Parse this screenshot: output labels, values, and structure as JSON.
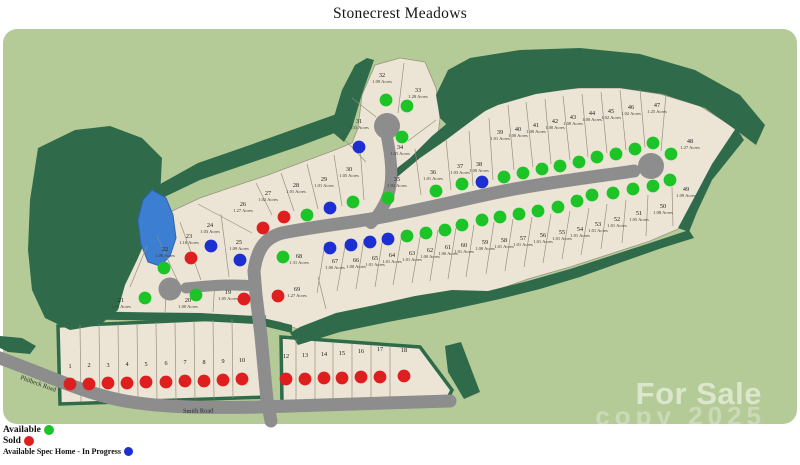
{
  "map": {
    "title": "Stonecrest Meadows",
    "legend": [
      {
        "label": "Available",
        "color": "#1dc427"
      },
      {
        "label": "Sold",
        "color": "#df1f1f"
      },
      {
        "label": "Available Spec Home - In Progress",
        "color": "#1c2fd1"
      }
    ],
    "watermark": {
      "text": "For Sale",
      "partial": "copy 2025"
    },
    "roads": [
      {
        "name": "Philbeck Road"
      },
      {
        "name": "Smith Road"
      }
    ],
    "status_colors": {
      "available": "#1dc427",
      "sold": "#df1f1f",
      "spec": "#1c2fd1"
    },
    "lots": [
      {
        "n": "1",
        "a": "",
        "s": "sold",
        "lx": 70,
        "ly": 368,
        "dx": 70,
        "dy": 384
      },
      {
        "n": "2",
        "a": "",
        "s": "sold",
        "lx": 89,
        "ly": 367,
        "dx": 89,
        "dy": 384
      },
      {
        "n": "3",
        "a": "",
        "s": "sold",
        "lx": 108,
        "ly": 367,
        "dx": 108,
        "dy": 383
      },
      {
        "n": "4",
        "a": "",
        "s": "sold",
        "lx": 127,
        "ly": 366,
        "dx": 127,
        "dy": 383
      },
      {
        "n": "5",
        "a": "",
        "s": "sold",
        "lx": 146,
        "ly": 366,
        "dx": 146,
        "dy": 382
      },
      {
        "n": "6",
        "a": "",
        "s": "sold",
        "lx": 166,
        "ly": 365,
        "dx": 166,
        "dy": 382
      },
      {
        "n": "7",
        "a": "",
        "s": "sold",
        "lx": 185,
        "ly": 364,
        "dx": 185,
        "dy": 381
      },
      {
        "n": "8",
        "a": "",
        "s": "sold",
        "lx": 204,
        "ly": 364,
        "dx": 204,
        "dy": 381
      },
      {
        "n": "9",
        "a": "",
        "s": "sold",
        "lx": 223,
        "ly": 363,
        "dx": 223,
        "dy": 380
      },
      {
        "n": "10",
        "a": "",
        "s": "sold",
        "lx": 242,
        "ly": 362,
        "dx": 242,
        "dy": 379
      },
      {
        "n": "12",
        "a": "",
        "s": "sold",
        "lx": 286,
        "ly": 358,
        "dx": 286,
        "dy": 379
      },
      {
        "n": "13",
        "a": "",
        "s": "sold",
        "lx": 305,
        "ly": 357,
        "dx": 305,
        "dy": 379
      },
      {
        "n": "14",
        "a": "",
        "s": "sold",
        "lx": 324,
        "ly": 356,
        "dx": 324,
        "dy": 378
      },
      {
        "n": "15",
        "a": "",
        "s": "sold",
        "lx": 342,
        "ly": 355,
        "dx": 342,
        "dy": 378
      },
      {
        "n": "16",
        "a": "",
        "s": "sold",
        "lx": 361,
        "ly": 353,
        "dx": 361,
        "dy": 377
      },
      {
        "n": "17",
        "a": "",
        "s": "sold",
        "lx": 380,
        "ly": 351,
        "dx": 380,
        "dy": 377
      },
      {
        "n": "18",
        "a": "",
        "s": "sold",
        "lx": 404,
        "ly": 352,
        "dx": 404,
        "dy": 376
      },
      {
        "n": "19",
        "a": "1.05",
        "s": "sold",
        "lx": 228,
        "ly": 294,
        "dx": 244,
        "dy": 299
      },
      {
        "n": "20",
        "a": "1.00",
        "s": "available",
        "lx": 188,
        "ly": 302,
        "dx": 196,
        "dy": 295
      },
      {
        "n": "21",
        "a": "1.10",
        "s": "available",
        "lx": 121,
        "ly": 302,
        "dx": 145,
        "dy": 298
      },
      {
        "n": "22",
        "a": "1.06",
        "s": "available",
        "lx": 165,
        "ly": 251,
        "dx": 164,
        "dy": 268
      },
      {
        "n": "23",
        "a": "1.10",
        "s": "sold",
        "lx": 189,
        "ly": 238,
        "dx": 191,
        "dy": 258
      },
      {
        "n": "24",
        "a": "1.03",
        "s": "spec",
        "lx": 210,
        "ly": 227,
        "dx": 211,
        "dy": 246
      },
      {
        "n": "25",
        "a": "1.09",
        "s": "spec",
        "lx": 239,
        "ly": 244,
        "dx": 240,
        "dy": 260
      },
      {
        "n": "26",
        "a": "1.27",
        "s": "sold",
        "lx": 243,
        "ly": 206,
        "dx": 263,
        "dy": 228
      },
      {
        "n": "27",
        "a": "1.02",
        "s": "sold",
        "lx": 268,
        "ly": 195,
        "dx": 284,
        "dy": 217
      },
      {
        "n": "28",
        "a": "1.01",
        "s": "available",
        "lx": 296,
        "ly": 187,
        "dx": 307,
        "dy": 215
      },
      {
        "n": "29",
        "a": "1.01",
        "s": "spec",
        "lx": 324,
        "ly": 181,
        "dx": 330,
        "dy": 208
      },
      {
        "n": "30",
        "a": "1.05",
        "s": "available",
        "lx": 349,
        "ly": 171,
        "dx": 353,
        "dy": 202
      },
      {
        "n": "31",
        "a": "1.33",
        "s": "spec",
        "lx": 359,
        "ly": 123,
        "dx": 359,
        "dy": 147
      },
      {
        "n": "32",
        "a": "1.09",
        "s": "available",
        "lx": 382,
        "ly": 77,
        "dx": 386,
        "dy": 100
      },
      {
        "n": "33",
        "a": "1.28",
        "s": "available",
        "lx": 418,
        "ly": 92,
        "dx": 407,
        "dy": 106
      },
      {
        "n": "34",
        "a": "1.05",
        "s": "available",
        "lx": 400,
        "ly": 149,
        "dx": 402,
        "dy": 137
      },
      {
        "n": "35",
        "a": "1.02",
        "s": "available",
        "lx": 397,
        "ly": 181,
        "dx": 388,
        "dy": 198
      },
      {
        "n": "36",
        "a": "1.01",
        "s": "available",
        "lx": 433,
        "ly": 174,
        "dx": 436,
        "dy": 191
      },
      {
        "n": "37",
        "a": "1.03",
        "s": "available",
        "lx": 460,
        "ly": 168,
        "dx": 462,
        "dy": 184
      },
      {
        "n": "38",
        "a": "1.00",
        "s": "spec",
        "lx": 479,
        "ly": 166,
        "dx": 482,
        "dy": 182
      },
      {
        "n": "39",
        "a": "1.01",
        "s": "available",
        "lx": 500,
        "ly": 134,
        "dx": 504,
        "dy": 177
      },
      {
        "n": "40",
        "a": "1.00",
        "s": "available",
        "lx": 518,
        "ly": 131,
        "dx": 523,
        "dy": 173
      },
      {
        "n": "41",
        "a": "1.00",
        "s": "available",
        "lx": 536,
        "ly": 127,
        "dx": 542,
        "dy": 169
      },
      {
        "n": "42",
        "a": "1.00",
        "s": "available",
        "lx": 555,
        "ly": 123,
        "dx": 560,
        "dy": 166
      },
      {
        "n": "43",
        "a": "1.00",
        "s": "available",
        "lx": 573,
        "ly": 119,
        "dx": 579,
        "dy": 162
      },
      {
        "n": "44",
        "a": "1.00",
        "s": "available",
        "lx": 592,
        "ly": 115,
        "dx": 597,
        "dy": 157
      },
      {
        "n": "45",
        "a": "1.02",
        "s": "available",
        "lx": 611,
        "ly": 113,
        "dx": 616,
        "dy": 154
      },
      {
        "n": "46",
        "a": "1.02",
        "s": "available",
        "lx": 631,
        "ly": 109,
        "dx": 635,
        "dy": 149
      },
      {
        "n": "47",
        "a": "1.25",
        "s": "available",
        "lx": 657,
        "ly": 107,
        "dx": 653,
        "dy": 143
      },
      {
        "n": "48",
        "a": "1.27",
        "s": "available",
        "lx": 690,
        "ly": 143,
        "dx": 671,
        "dy": 154
      },
      {
        "n": "49",
        "a": "1.09",
        "s": "available",
        "lx": 686,
        "ly": 191,
        "dx": 670,
        "dy": 180
      },
      {
        "n": "50",
        "a": "1.08",
        "s": "available",
        "lx": 663,
        "ly": 208,
        "dx": 653,
        "dy": 186
      },
      {
        "n": "51",
        "a": "1.05",
        "s": "available",
        "lx": 639,
        "ly": 215,
        "dx": 633,
        "dy": 189
      },
      {
        "n": "52",
        "a": "1.01",
        "s": "available",
        "lx": 617,
        "ly": 221,
        "dx": 613,
        "dy": 193
      },
      {
        "n": "53",
        "a": "1.01",
        "s": "available",
        "lx": 598,
        "ly": 226,
        "dx": 592,
        "dy": 195
      },
      {
        "n": "54",
        "a": "1.01",
        "s": "available",
        "lx": 580,
        "ly": 231,
        "dx": 577,
        "dy": 201
      },
      {
        "n": "55",
        "a": "1.01",
        "s": "available",
        "lx": 562,
        "ly": 234,
        "dx": 558,
        "dy": 207
      },
      {
        "n": "56",
        "a": "1.01",
        "s": "available",
        "lx": 543,
        "ly": 237,
        "dx": 538,
        "dy": 211
      },
      {
        "n": "57",
        "a": "1.01",
        "s": "available",
        "lx": 523,
        "ly": 240,
        "dx": 519,
        "dy": 214
      },
      {
        "n": "58",
        "a": "1.01",
        "s": "available",
        "lx": 504,
        "ly": 242,
        "dx": 500,
        "dy": 217
      },
      {
        "n": "59",
        "a": "1.00",
        "s": "available",
        "lx": 485,
        "ly": 244,
        "dx": 482,
        "dy": 220
      },
      {
        "n": "60",
        "a": "1.01",
        "s": "available",
        "lx": 464,
        "ly": 247,
        "dx": 462,
        "dy": 225
      },
      {
        "n": "61",
        "a": "1.00",
        "s": "available",
        "lx": 448,
        "ly": 249,
        "dx": 445,
        "dy": 230
      },
      {
        "n": "62",
        "a": "1.00",
        "s": "available",
        "lx": 430,
        "ly": 252,
        "dx": 426,
        "dy": 233
      },
      {
        "n": "63",
        "a": "1.01",
        "s": "available",
        "lx": 412,
        "ly": 255,
        "dx": 407,
        "dy": 236
      },
      {
        "n": "64",
        "a": "1.01",
        "s": "spec",
        "lx": 392,
        "ly": 257,
        "dx": 388,
        "dy": 239
      },
      {
        "n": "65",
        "a": "1.01",
        "s": "spec",
        "lx": 375,
        "ly": 260,
        "dx": 370,
        "dy": 242
      },
      {
        "n": "66",
        "a": "1.00",
        "s": "spec",
        "lx": 356,
        "ly": 262,
        "dx": 351,
        "dy": 245
      },
      {
        "n": "67",
        "a": "1.00",
        "s": "spec",
        "lx": 335,
        "ly": 263,
        "dx": 330,
        "dy": 248
      },
      {
        "n": "68",
        "a": "1.31",
        "s": "available",
        "lx": 299,
        "ly": 258,
        "dx": 283,
        "dy": 257
      },
      {
        "n": "69",
        "a": "1.27",
        "s": "sold",
        "lx": 297,
        "ly": 291,
        "dx": 278,
        "dy": 296
      }
    ]
  }
}
